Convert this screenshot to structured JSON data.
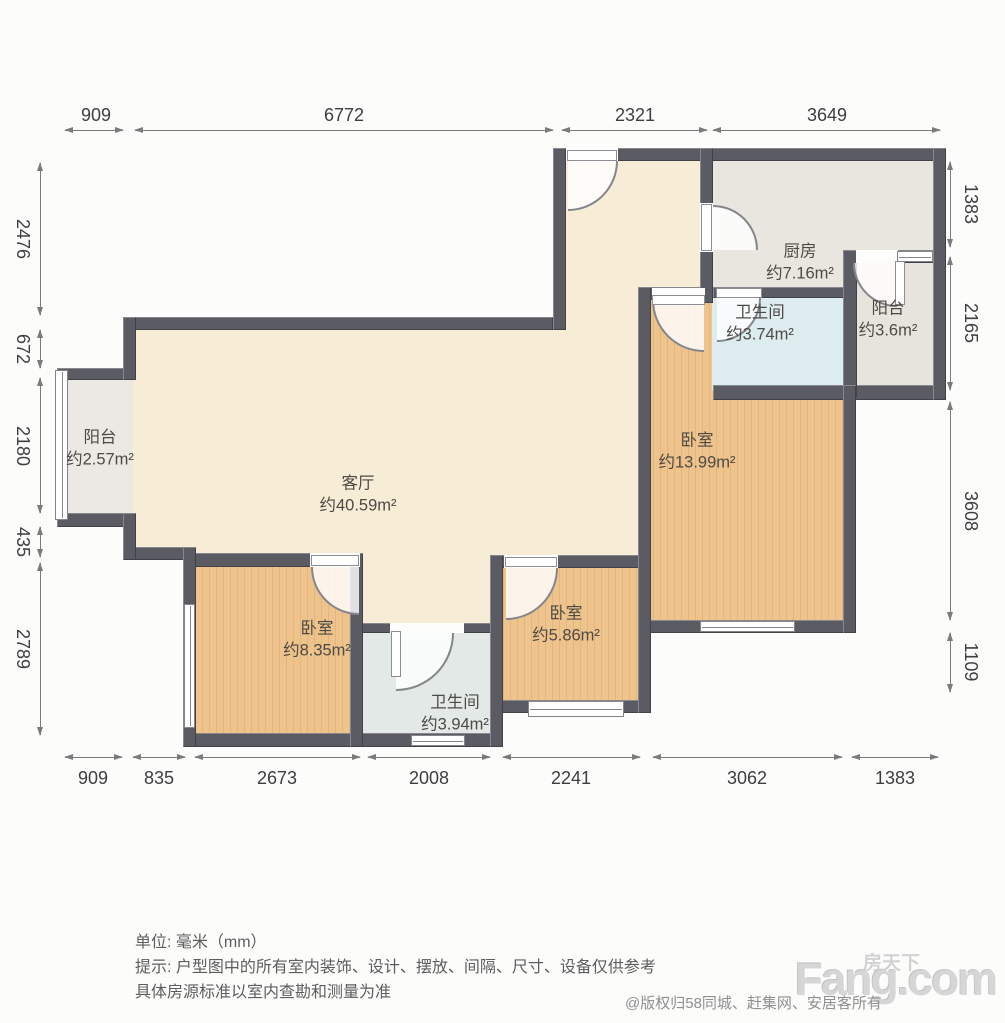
{
  "plan": {
    "rooms": {
      "living": {
        "name": "客厅",
        "area": "约40.59m²"
      },
      "bedroom_large": {
        "name": "卧室",
        "area": "约13.99m²"
      },
      "bedroom_left": {
        "name": "卧室",
        "area": "约8.35m²"
      },
      "bedroom_mid": {
        "name": "卧室",
        "area": "约5.86m²"
      },
      "kitchen": {
        "name": "厨房",
        "area": "约7.16m²"
      },
      "bath_upper": {
        "name": "卫生间",
        "area": "约3.74m²"
      },
      "bath_lower": {
        "name": "卫生间",
        "area": "约3.94m²"
      },
      "balcony_left": {
        "name": "阳台",
        "area": "约2.57m²"
      },
      "balcony_right": {
        "name": "阳台",
        "area": "约3.6m²"
      }
    },
    "dimensions_mm": {
      "top": [
        "909",
        "6772",
        "2321",
        "3649"
      ],
      "left": [
        "2476",
        "672",
        "2180",
        "435",
        "2789"
      ],
      "right": [
        "1383",
        "2165",
        "3608",
        "1109"
      ],
      "bottom": [
        "909",
        "835",
        "2673",
        "2008",
        "2241",
        "3062",
        "1383"
      ]
    }
  },
  "footer": {
    "unit_line": "单位: 毫米（mm）",
    "tip_line1": "提示: 户型图中的所有室内装饰、设计、摆放、间隔、尺寸、设备仅供参考",
    "tip_line2": "具体房源标准以室内查勘和测量为准"
  },
  "watermark": {
    "logo_cn": "房天下",
    "logo_en": "Fang.com",
    "copyright": "@版权归58同城、赶集网、安居客所有"
  },
  "colors": {
    "wall": "#5b5b63",
    "wood_floor": "#eec48c",
    "living_floor": "#f7ecd6",
    "kitchen_floor": "#e9e6df",
    "bath_floor": "#ddecef"
  }
}
